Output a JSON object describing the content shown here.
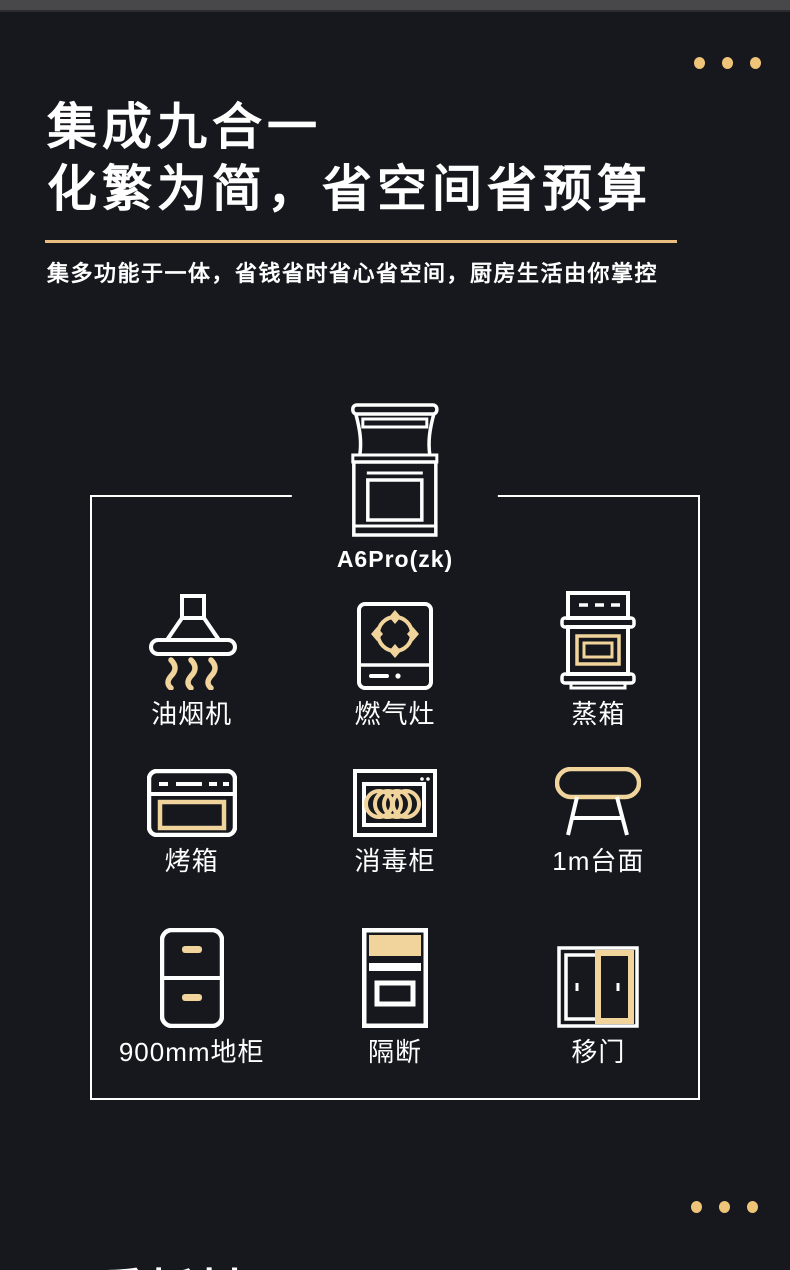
{
  "colors": {
    "background": "#16181d",
    "top_strip": "#48484a",
    "accent_gold_dots": "#eec478",
    "divider_gold": "#e9bd7d",
    "icon_gold": "#f0d49c",
    "text_white": "#ffffff"
  },
  "header": {
    "title_line1": "集成九合一",
    "title_line2": "化繁为简，省空间省预算",
    "subtitle": "集多功能于一体，省钱省时省心省空间，厨房生活由你掌控"
  },
  "product": {
    "model_label": "A6Pro(zk)",
    "icon": "integrated-stove-icon"
  },
  "features": [
    {
      "label": "油烟机",
      "icon": "range-hood-icon"
    },
    {
      "label": "燃气灶",
      "icon": "gas-stove-icon"
    },
    {
      "label": "蒸箱",
      "icon": "steam-oven-icon"
    },
    {
      "label": "烤箱",
      "icon": "oven-icon"
    },
    {
      "label": "消毒柜",
      "icon": "disinfection-cabinet-icon"
    },
    {
      "label": "1m台面",
      "icon": "countertop-icon"
    },
    {
      "label": "900mm地柜",
      "icon": "base-cabinet-icon"
    },
    {
      "label": "隔断",
      "icon": "partition-icon"
    },
    {
      "label": "移门",
      "icon": "sliding-door-icon"
    }
  ],
  "decorations": {
    "top_dots_count": 3,
    "bottom_dots_count": 3
  },
  "next_section": {
    "partial_title": "三重板材"
  }
}
